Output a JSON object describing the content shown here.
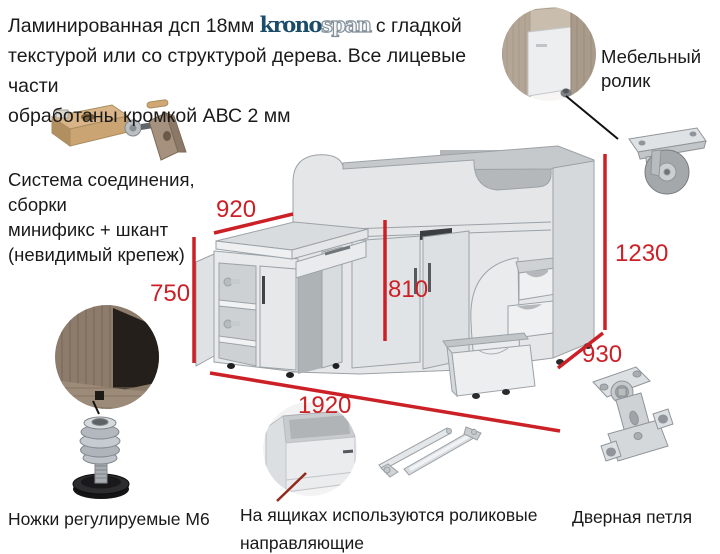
{
  "intro": {
    "line1_before_logo": "Ламинированная дсп 18мм ",
    "logo_solid": "krono",
    "logo_outline": "span",
    "line1_after_logo": "  с гладкой",
    "line2": "текстурой или со структурой дерева. Все лицевые части",
    "line3": "обработаны кромкой АВС 2 мм"
  },
  "notes": {
    "roller": {
      "line1": "Мебельный",
      "line2": "ролик"
    },
    "connection": {
      "line1": "Система соединения,",
      "line2": "сборки",
      "line3": "минификс + шкант",
      "line4": "(невидимый крепеж)"
    },
    "feet": "Ножки регулируемые М6",
    "slides": {
      "line1": "На ящиках используются роликовые",
      "line2": "направляющие"
    },
    "hinge": "Дверная петля"
  },
  "dimensions_mm": {
    "desk_width": "920",
    "desk_height": "750",
    "under_bed_height": "810",
    "overall_height": "1230",
    "depth": "930",
    "overall_width": "1920"
  },
  "images": {
    "roller_corner": "drawer-with-furniture-roller-photo",
    "caster": "caster-wheel-photo",
    "minifix": "minifix-and-dowel-fittings-photo",
    "wood_corner": "cabinet-bottom-corner-photo",
    "foot": "adjustable-threaded-foot-photo",
    "open_drawer": "open-drawer-photo",
    "slides": "roller-drawer-slides-photo",
    "hinge": "concealed-door-hinge-photo",
    "furniture": "loft-bed-with-desk-line-drawing"
  },
  "colors": {
    "dimension_red": "#cc2027",
    "pointer_dark_red": "#93281c",
    "logo_blue": "#1d4c6a",
    "text_black": "#1a1a1a",
    "furniture_gray": "#e4e6e8"
  }
}
